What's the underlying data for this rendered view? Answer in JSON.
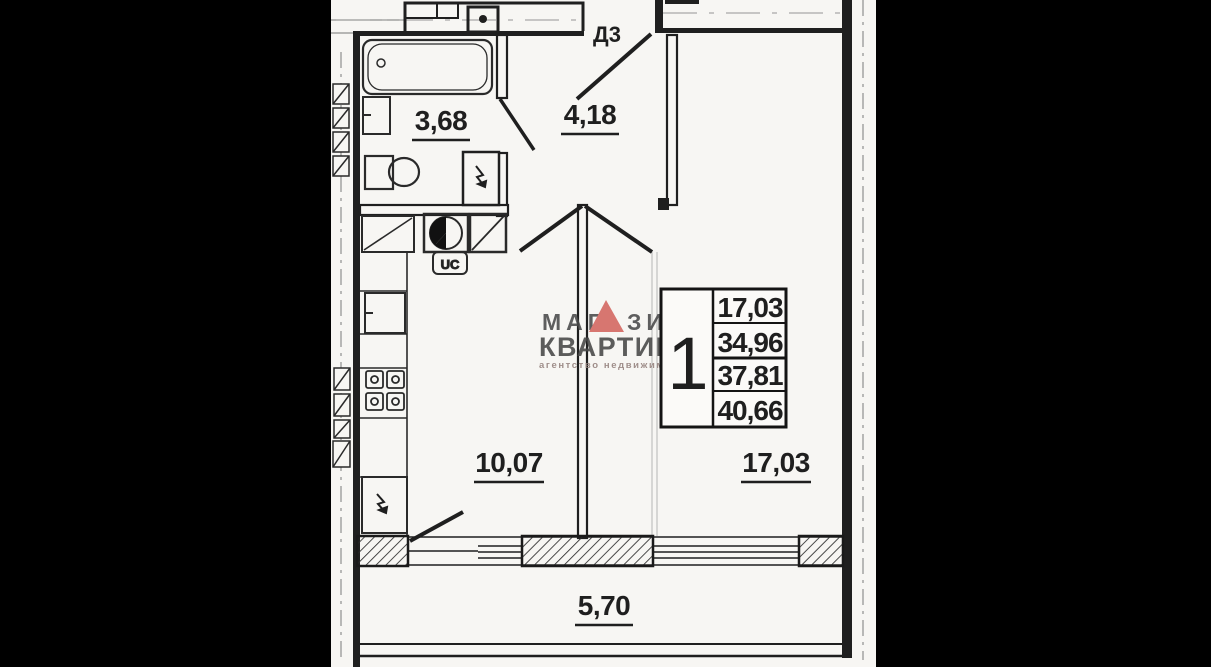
{
  "rooms": {
    "bathroom": {
      "label": "3,68"
    },
    "hallway": {
      "label": "4,18"
    },
    "kitchen": {
      "label": "10,07"
    },
    "living": {
      "label": "17,03"
    },
    "balcony": {
      "label": "5,70"
    }
  },
  "door": {
    "label": "Д3"
  },
  "fixtures": {
    "uc_label": "UC"
  },
  "stamp": {
    "rooms_count": "1",
    "values": [
      "17,03",
      "34,96",
      "37,81",
      "40,66"
    ]
  },
  "watermark": {
    "line1_left": "МАГ",
    "line1_right": "ЗИН",
    "line2": "КВАРТИР",
    "line3": "агентство недвижимости",
    "triangle_color": "#d3655e",
    "text_color": "#4a4a4a",
    "subtext_color": "#93807c"
  },
  "colors": {
    "paper": "#f7f6f3",
    "line": "#1f1f1f",
    "faint_line": "#9a9a9a",
    "mask": "#000000"
  }
}
